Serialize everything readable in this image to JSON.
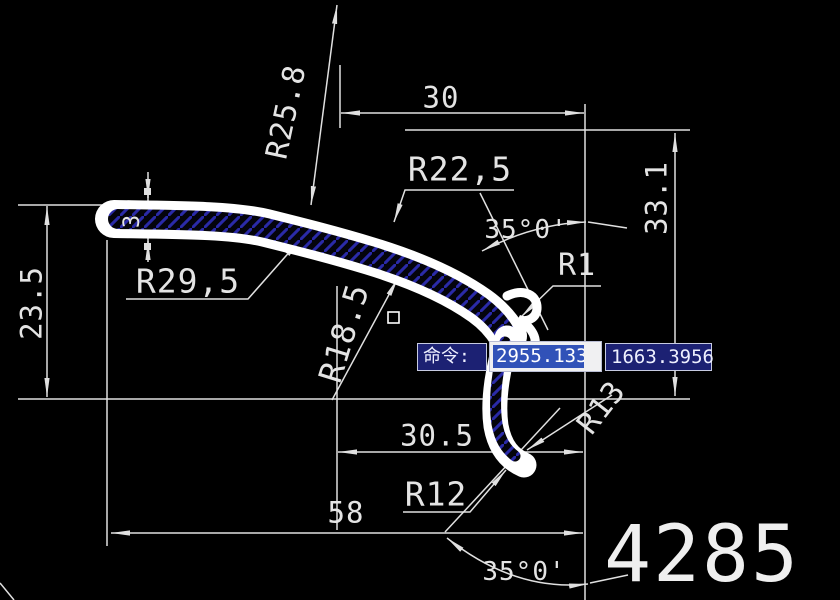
{
  "window": {
    "description": "AutoCAD drawing canvas with sectioned rubber seal profile",
    "background": "#000000"
  },
  "dimensions": {
    "top_width": "30",
    "radius_top": "R25.8",
    "radius_upper": "R22,5",
    "angle_top": "35°0'",
    "radius_small": "R1",
    "height_right": "33.1",
    "radius_left": "R29,5",
    "height_left": "23.5",
    "wall_thickness": "3",
    "radius_mid": "R18.5",
    "width_mid": "30.5",
    "radius_tail_outer": "R13",
    "radius_tail": "R12",
    "width_bottom": "58",
    "angle_bottom": "35°0'"
  },
  "command_bar": {
    "prompt": "命令:",
    "x_value": "2955.1335",
    "y_value": "1663.3956"
  },
  "drawing_number": "4285",
  "colors": {
    "dimension_lines": "#e0e0e0",
    "profile_wall": "#ffffff",
    "section_hatch": "#2a2aa8",
    "command_box_bg": "#1c2173",
    "selection_highlight": "#3152b8"
  }
}
